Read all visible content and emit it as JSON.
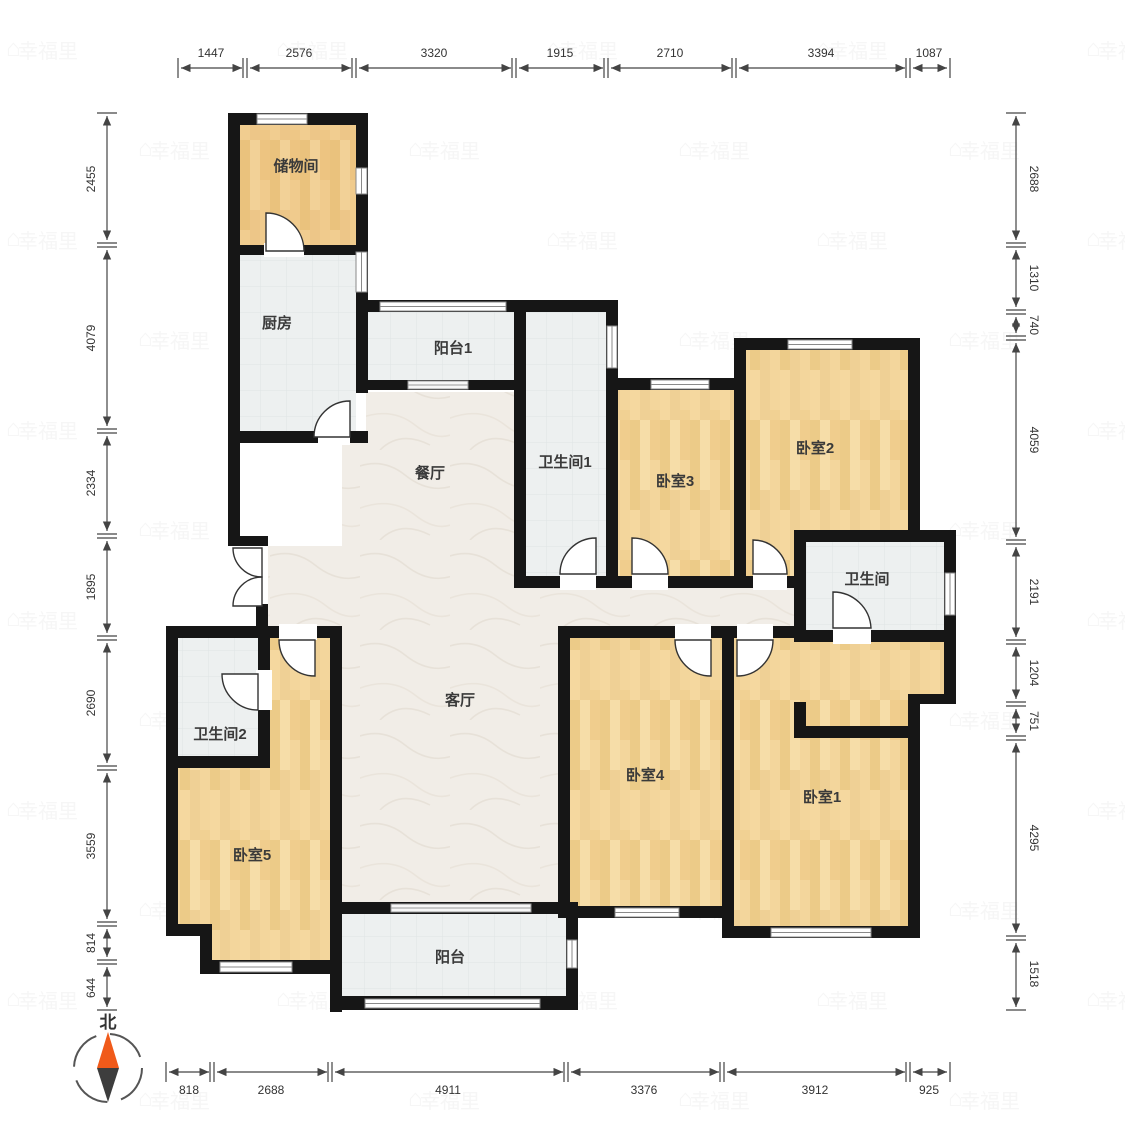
{
  "plan": {
    "rooms": {
      "storage": "储物间",
      "kitchen": "厨房",
      "balcony1": "阳台1",
      "dining": "餐厅",
      "bath1": "卫生间1",
      "bed3": "卧室3",
      "bed2": "卧室2",
      "bath_master": "卫生间",
      "living": "客厅",
      "bath2": "卫生间2",
      "bed5": "卧室5",
      "bed4": "卧室4",
      "bed1": "卧室1",
      "balcony": "阳台"
    },
    "dims": {
      "top": [
        "1447",
        "2576",
        "3320",
        "1915",
        "2710",
        "3394",
        "1087"
      ],
      "bottom": [
        "818",
        "2688",
        "4911",
        "3376",
        "3912",
        "925"
      ],
      "left": [
        "2455",
        "4079",
        "2334",
        "1895",
        "2690",
        "3559",
        "814",
        "644"
      ],
      "right": [
        "2688",
        "1310",
        "740",
        "4059",
        "2191",
        "1204",
        "751",
        "4295",
        "1518"
      ]
    },
    "compass": {
      "north": "北"
    },
    "watermark": "幸福里",
    "colors": {
      "wall": "#161616",
      "wood_floor": "#f1d193",
      "tile_floor": "#edf0f0",
      "marble_floor": "#f1ede7",
      "compass_needle_north": "#f05a1a",
      "compass_needle_south": "#3d3d3d",
      "dimension_text": "#333333"
    }
  }
}
